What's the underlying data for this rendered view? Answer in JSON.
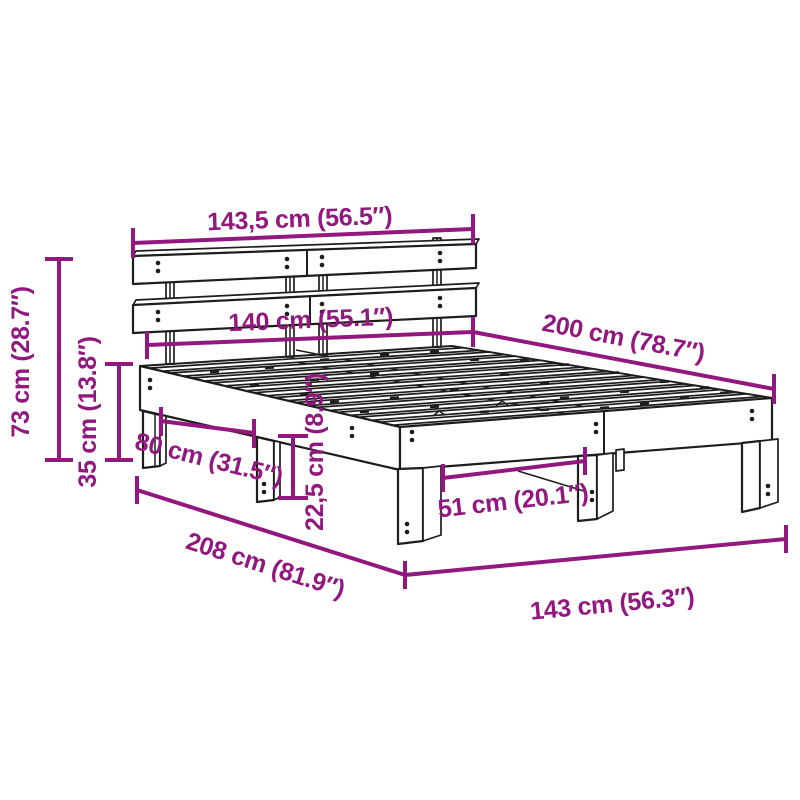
{
  "diagram": {
    "subject": "bed-frame-with-headboard-dimension-drawing",
    "background_color": "#ffffff",
    "dimension_color": "#92187f",
    "drawing_color": "#1d1d1b",
    "dimensions": {
      "headboard_width": "143,5 cm (56.5″)",
      "slat_area_width": "140 cm (55.1″)",
      "bed_length": "200 cm (78.7″)",
      "headboard_height": "73 cm (28.7″)",
      "frame_height": "35 cm (13.8″)",
      "side_leg_spacing": "80 cm (31.5″)",
      "under_bed_clearance": "22,5 cm (8.9″)",
      "foot_leg_spacing": "51 cm (20.1″)",
      "total_length": "208 cm (81.9″)",
      "total_width": "143 cm (56.3″)"
    }
  }
}
